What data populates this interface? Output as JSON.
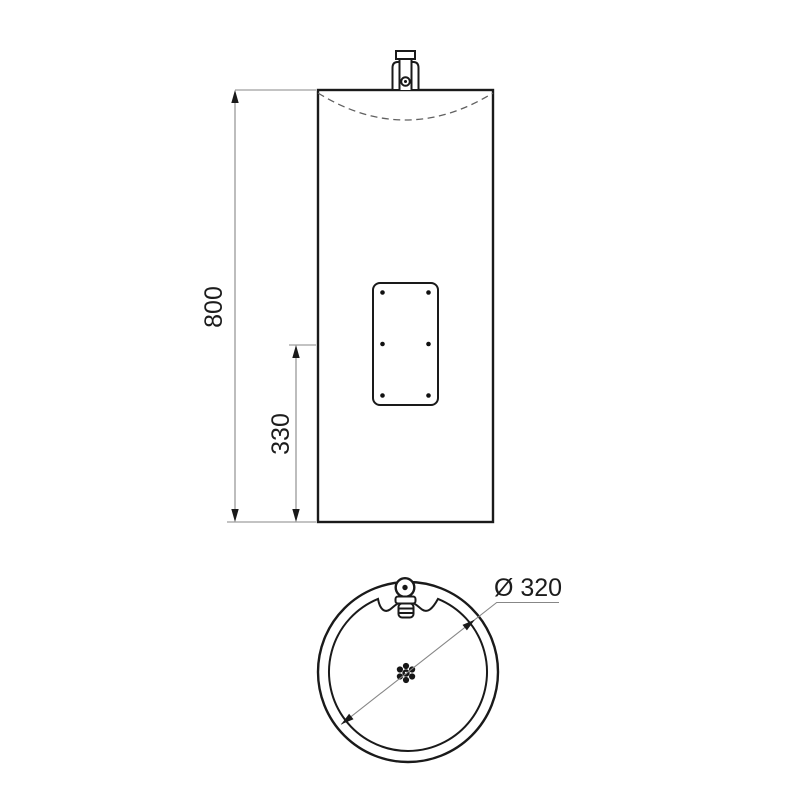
{
  "drawing": {
    "kind": "technical-dimension-drawing",
    "dimensions": [
      {
        "id": "total-height",
        "value": "800",
        "orientation": "vertical"
      },
      {
        "id": "lower-section-height",
        "value": "330",
        "orientation": "vertical"
      },
      {
        "id": "outer-diameter",
        "value": "Ø 320",
        "orientation": "diagonal-leader"
      }
    ],
    "colors": {
      "object_line": "#1a1a1a",
      "dimension_line": "#878787",
      "hidden_line": "#606060",
      "text": "#1c1c1c",
      "background": "#ffffff"
    }
  }
}
